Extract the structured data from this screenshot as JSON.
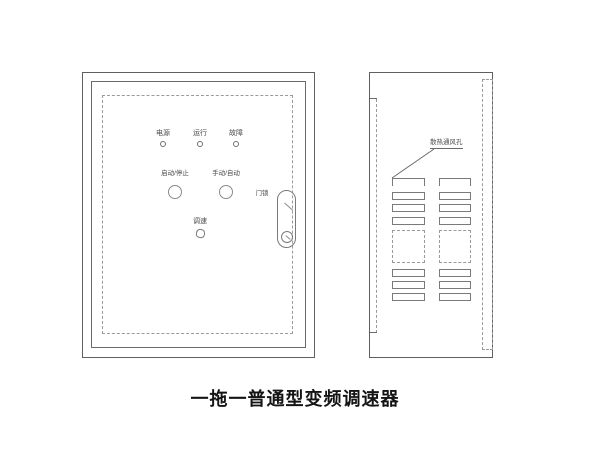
{
  "caption": "一拖一普通型变频调速器",
  "front_panel": {
    "indicator_labels": [
      "电源",
      "运行",
      "故障"
    ],
    "button_labels": [
      "启动/停止",
      "手动/自动"
    ],
    "knob_label": "调速",
    "door_lock_label": "门锁"
  },
  "side_panel": {
    "vent_label": "散热通风孔"
  },
  "colors": {
    "line": "#5f5f5f",
    "dashed_line": "#9a9a9a",
    "text": "#4a4a4a",
    "background": "#ffffff"
  }
}
